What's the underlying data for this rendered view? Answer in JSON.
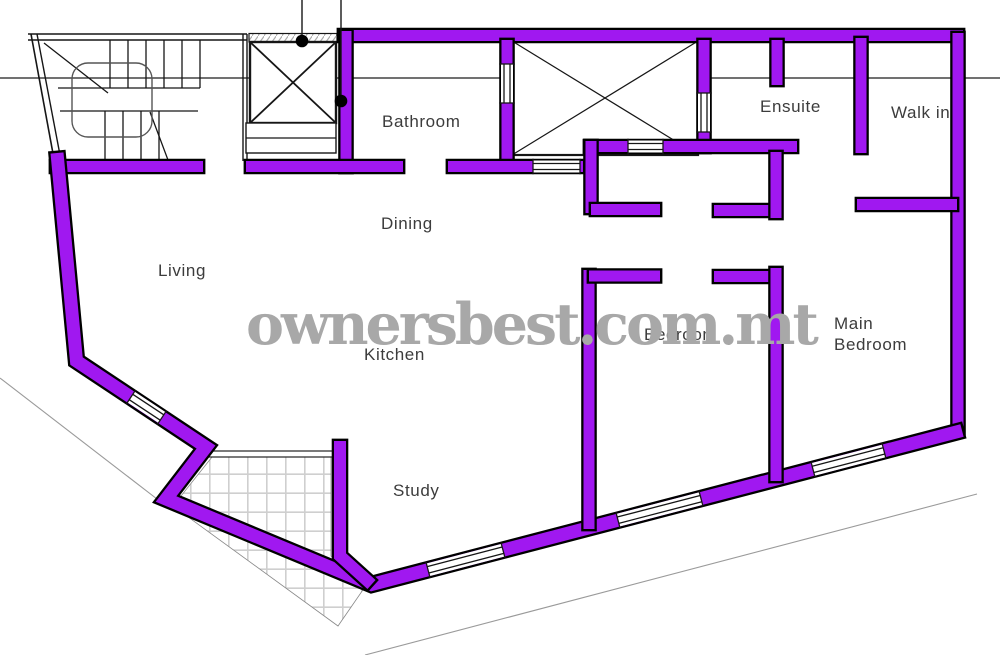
{
  "watermark": "ownersbest.com.mt",
  "rooms": {
    "bathroom": "Bathroom",
    "dining": "Dining",
    "living": "Living",
    "kitchen": "Kitchen",
    "study": "Study",
    "bedroom": "Bedroom",
    "main_bedroom": {
      "line1": "Main",
      "line2": "Bedroom"
    },
    "ensuite": "Ensuite",
    "walk_in": "Walk in"
  },
  "colors": {
    "wall": "#a018f0",
    "wall_outline": "#000000",
    "thin_line": "#161616",
    "site_line": "#1c1c1c",
    "boundary_line": "#9a9a9a",
    "label": "#3c3c3c",
    "watermark": "#a8a8a8",
    "tile_line": "#cfcfcf",
    "handrail": "#555555",
    "hatch": "#aaaaaa"
  }
}
